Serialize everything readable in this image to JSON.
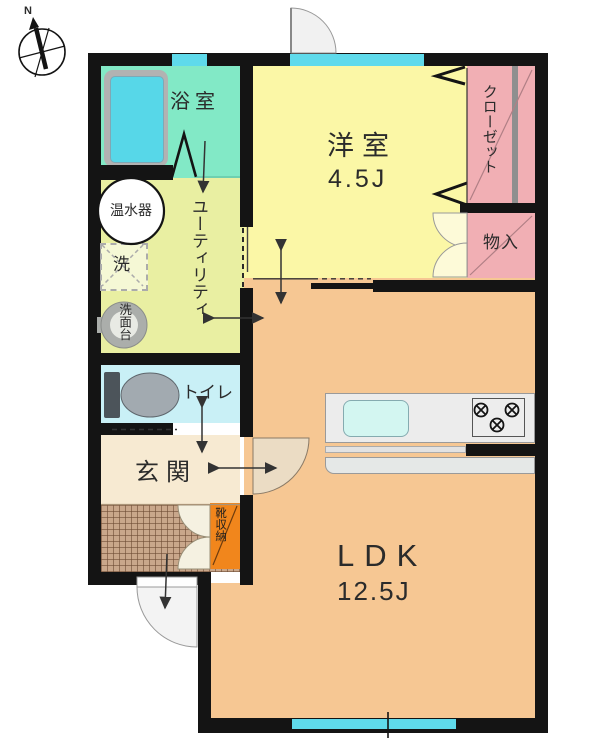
{
  "title": "1LDK apartment floor plan",
  "compass": {
    "north_label": "N"
  },
  "rooms": {
    "bathroom": {
      "label": "浴室"
    },
    "western_room": {
      "label": "洋室",
      "size": "4.5J"
    },
    "closet": {
      "label": "クローゼット"
    },
    "storage": {
      "label": "物入"
    },
    "water_heater": {
      "label": "温水器"
    },
    "washer": {
      "label": "洗"
    },
    "washstand": {
      "label": "洗面台"
    },
    "utility": {
      "label": "ユーティリティ"
    },
    "toilet": {
      "label": "トイレ"
    },
    "entrance": {
      "label": "玄関"
    },
    "shoe_storage": {
      "label": "靴収納"
    },
    "ldk": {
      "label": "LDK",
      "size": "12.5J"
    }
  },
  "colors": {
    "wall": "#141414",
    "window_glass": "#5FDAEB",
    "bathroom": "#82E9C6",
    "bathtub": "#57D7E8",
    "utility": "#E9EFA2",
    "western_room": "#FBF7A6",
    "closet_storage": "#F1AFB4",
    "toilet": "#C9F0F6",
    "entrance_hall": "#F7EAD2",
    "entrance_tile": "#C9A78B",
    "shoe_storage": "#F1861C",
    "ldk": "#F6C793",
    "kitchen_counter": "#ECECEC"
  }
}
